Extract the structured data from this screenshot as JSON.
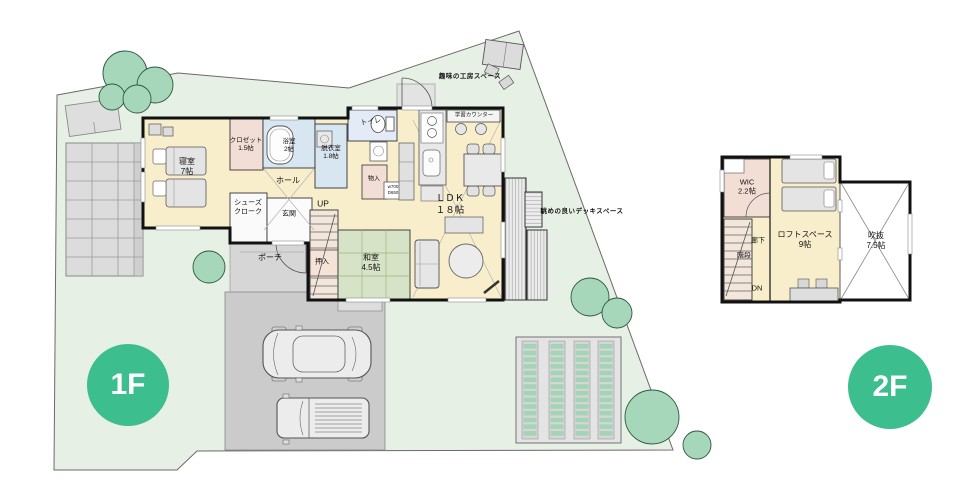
{
  "title": "間取り図 (1F / 2F)",
  "badges": {
    "f1": "1F",
    "f2": "2F"
  },
  "f1": {
    "bedroom": {
      "name": "寝室",
      "size": "7帖"
    },
    "closet": {
      "name": "クロゼット",
      "size": "1.5帖"
    },
    "bath": {
      "name": "浴室",
      "size": "2帖"
    },
    "dressing": {
      "name": "脱衣室",
      "size": "1.8帖"
    },
    "toilet": {
      "name": "トイレ"
    },
    "hall": {
      "name": "ホール"
    },
    "shoes_closet": {
      "line1": "シューズ",
      "line2": "クローク"
    },
    "entrance": {
      "name": "玄関"
    },
    "porch": {
      "name": "ポーチ"
    },
    "stairs_up": {
      "name": "UP"
    },
    "oshiire": {
      "name": "押入"
    },
    "washitsu": {
      "name": "和室",
      "size": "4.5帖"
    },
    "ldk": {
      "name": "ＬＤＫ",
      "size": "１８帖"
    },
    "storage": {
      "name": "物入",
      "w": "w700",
      "d": "D650"
    },
    "study_counter": {
      "name": "学習カウンター"
    },
    "deck": {
      "name": "眺めの良いデッキスペース"
    },
    "workshop": {
      "name": "趣味の工房スペース"
    }
  },
  "f2": {
    "wic": {
      "name": "WIC",
      "size": "2.2帖"
    },
    "hallway": {
      "name": "廊下"
    },
    "stairs": {
      "name": "階段"
    },
    "stairs_down": {
      "name": "DN"
    },
    "loft": {
      "name": "ロフトスペース",
      "size": "9帖"
    },
    "void": {
      "name": "吹抜",
      "size": "7.5帖"
    }
  },
  "colors": {
    "accent_green": "#3cbe8e",
    "site_green": "#e6f0e4",
    "floor_cream": "#f8eecb",
    "tatami_green": "#d6e3c6",
    "wet_blue": "#d7e6f1",
    "closet_pink": "#f2ded5",
    "driveway_gray": "#cbcbcb",
    "tree_green": "#a6d7ba",
    "wall_black": "#111111"
  }
}
